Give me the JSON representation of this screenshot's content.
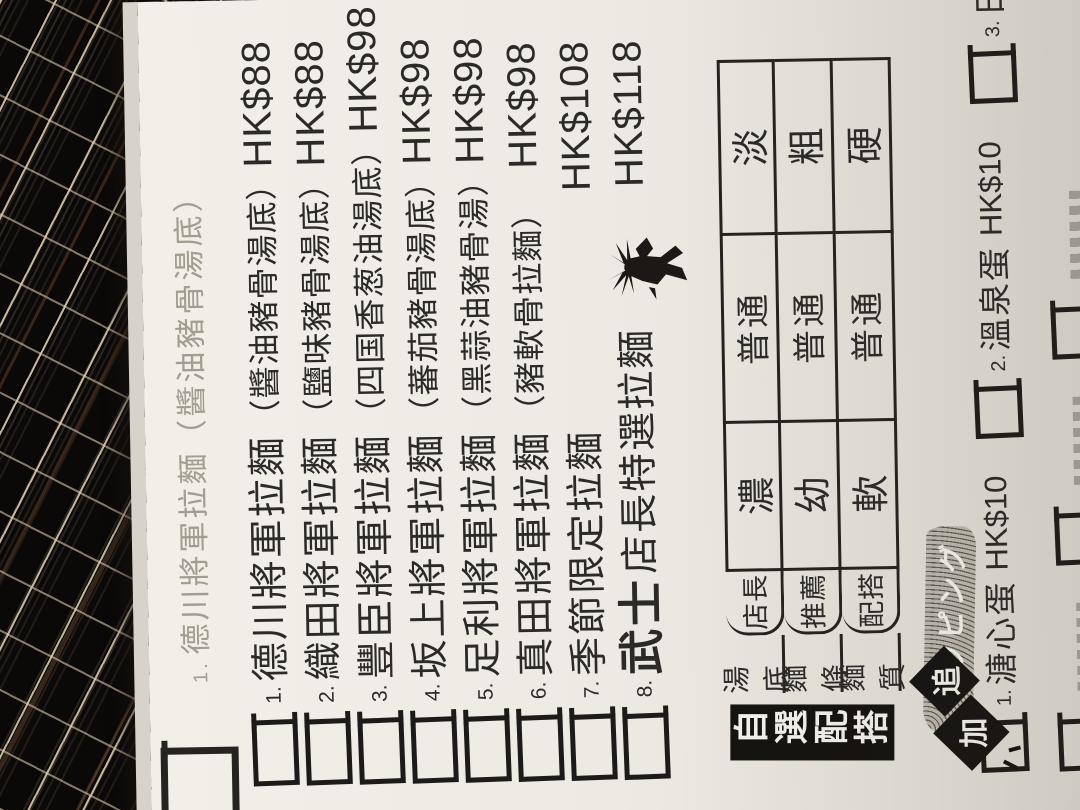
{
  "colors": {
    "paper": "#efece5",
    "ink": "#2c2a27",
    "faint_ink": "#a39c90",
    "placemat_dark": "#0e0c0a",
    "placemat_highlight": "#e4d3b4",
    "placemat_copper": "#ab6f46",
    "banner_bg": "#15130f",
    "banner_fg": "#f4f2ec"
  },
  "menu": {
    "ghost_line": {
      "number": "1.",
      "name": "德川將軍拉麵",
      "subname": "（醬油豬骨湯底）"
    },
    "items": [
      {
        "number": "1.",
        "name_emphasis": "",
        "name": "德川將軍拉麵",
        "subname": "（醬油豬骨湯底）",
        "price": "HK$88"
      },
      {
        "number": "2.",
        "name_emphasis": "",
        "name": "織田將軍拉麵",
        "subname": "（鹽味豬骨湯底）",
        "price": "HK$88"
      },
      {
        "number": "3.",
        "name_emphasis": "",
        "name": "豐臣將軍拉麵",
        "subname": "（四国香葱油湯底）",
        "price": "HK$98"
      },
      {
        "number": "4.",
        "name_emphasis": "",
        "name": "坂上將軍拉麵",
        "subname": "（蕃茄豬骨湯底）",
        "price": "HK$98"
      },
      {
        "number": "5.",
        "name_emphasis": "",
        "name": "足利將軍拉麵",
        "subname": "（黑蒜油豬骨湯）",
        "price": "HK$98"
      },
      {
        "number": "6.",
        "name_emphasis": "",
        "name": "真田將軍拉麵",
        "subname": "（豬軟骨拉麵）",
        "price": "HK$98"
      },
      {
        "number": "7.",
        "name_emphasis": "",
        "name": "季節限定拉麵",
        "subname": "",
        "price": "HK$108"
      },
      {
        "number": "8.",
        "name_emphasis": "武士",
        "name": "店長特選拉麵",
        "subname": "",
        "price": "HK$118"
      }
    ],
    "options": {
      "banner": "自選配搭",
      "recommend_phrase": "店長推薦配搭",
      "rows": [
        {
          "label": "湯底",
          "rec": "店長",
          "values": [
            "濃",
            "普通",
            "淡"
          ]
        },
        {
          "label": "麵條",
          "rec": "推薦",
          "values": [
            "幼",
            "普通",
            "粗"
          ]
        },
        {
          "label": "麵質",
          "rec": "配搭",
          "values": [
            "軟",
            "普通",
            "硬"
          ]
        }
      ]
    },
    "addons": {
      "badge_chars": [
        "追",
        "加"
      ],
      "brush_text": "トッピング",
      "items": [
        {
          "number": "1.",
          "name": "溏心蛋",
          "price": "HK$10"
        },
        {
          "number": "2.",
          "name": "溫泉蛋",
          "price": "HK$10"
        },
        {
          "number": "3.",
          "name": "日式叉燒",
          "price": "HK$10"
        }
      ]
    }
  }
}
